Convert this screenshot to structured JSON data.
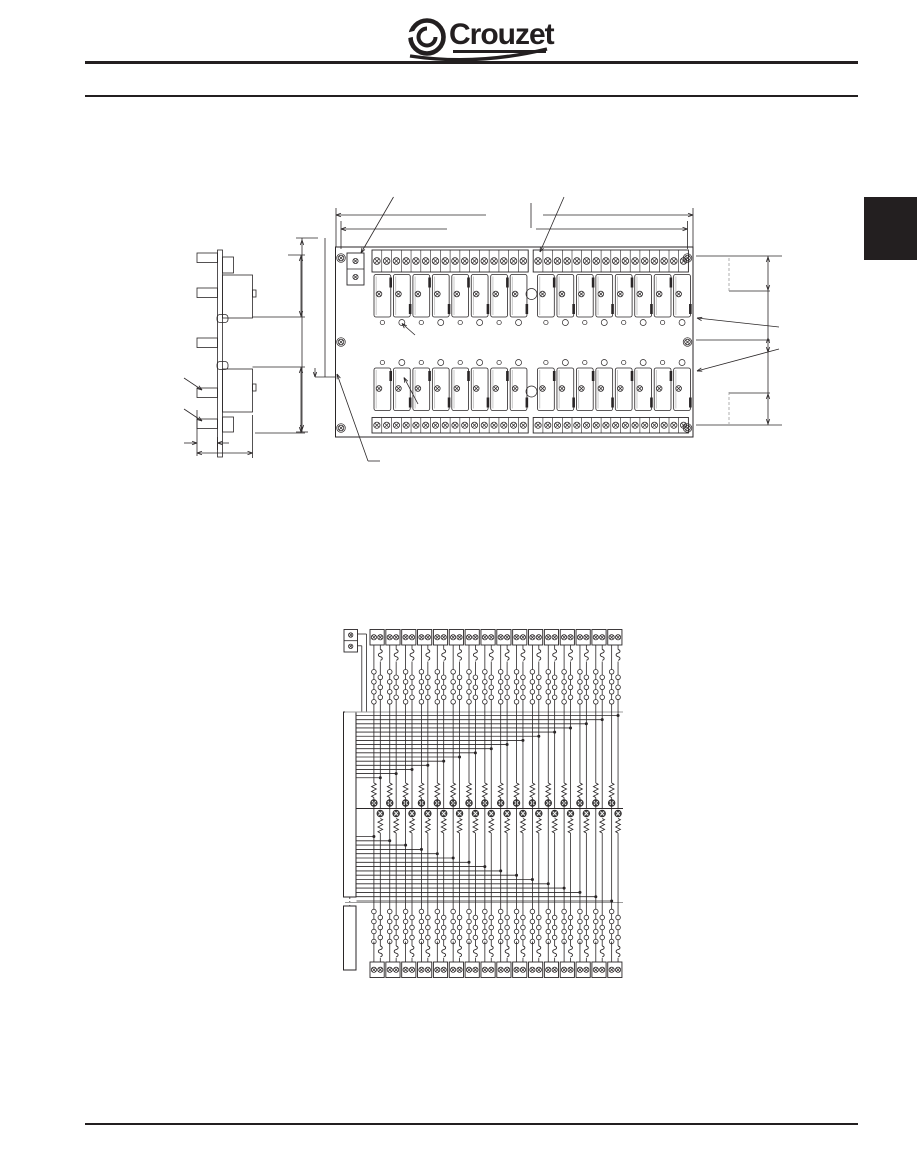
{
  "page": {
    "bg": "#ffffff",
    "ink": "#2a2627",
    "gray": "#9c9c9c",
    "black": "#231f20"
  },
  "header": {
    "brand": "Crouzet",
    "emblem": "crouzet-ring-icon"
  },
  "side_tab": {
    "color": "#231f20"
  },
  "mechanical": {
    "description": "relay interface module dimensional drawing",
    "side_view": {
      "terminal_blocks": 5,
      "relay_bodies": 2
    },
    "top_view": {
      "relay_rows": 2,
      "relays_per_row": 16,
      "strip_groups": 2,
      "terminals_per_group": 16,
      "mounting_screws": 6,
      "aux_terminals": 2
    }
  },
  "schematic": {
    "description": "relay interface module wiring diagram",
    "channels": 16,
    "aux_terminals": 2,
    "connectors": 2,
    "contact_circles_left": 4,
    "contact_circles_right": 3,
    "per_channel": [
      "fuse-switch",
      "contacts",
      "resistor",
      "led",
      "led",
      "resistor",
      "contacts",
      "fuse-switch"
    ]
  },
  "footer": {
    "rule": true
  }
}
